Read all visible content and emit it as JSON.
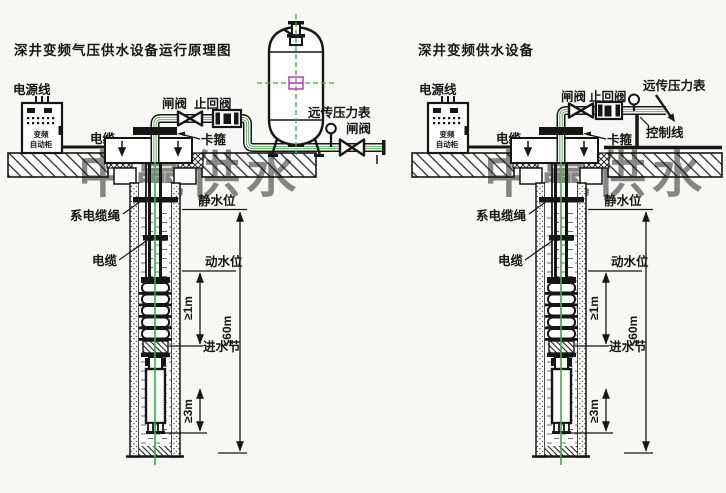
{
  "watermark": {
    "text": "中赢供水"
  },
  "shared": {
    "power_line": "电源线",
    "cabinet_line1": "变频",
    "cabinet_line2": "自动柜",
    "cable": "电缆",
    "clamp": "卡箍",
    "cable_rope": "系电缆绳",
    "cable_well": "电缆",
    "static_level": "静水位",
    "dynamic_level": "动水位",
    "inlet": "进水节",
    "dims": {
      "d1": "≥1m",
      "d3": "≥3m",
      "d60": "≤60m"
    }
  },
  "diagrams": [
    {
      "title": "深井变频气压供水设备运行原理图",
      "labels": {
        "gate_valve": "闸阀",
        "check_valve": "止回阀",
        "pressure_gauge": "远传压力表",
        "outlet_gate_valve": "闸阀"
      }
    },
    {
      "title": "深井变频供水设备",
      "labels": {
        "gate_valve": "闸阀",
        "check_valve": "止回阀",
        "pressure_gauge": "远传压力表",
        "control_line": "控制线"
      }
    }
  ],
  "colors": {
    "pipe_green": "#3bb03b",
    "centerline_green": "#3bb03b",
    "watermark_red": "#ee4a4a",
    "tank_centerline_magenta": "#c545c5",
    "line_black": "#161616",
    "background": "#f7f7f4"
  }
}
